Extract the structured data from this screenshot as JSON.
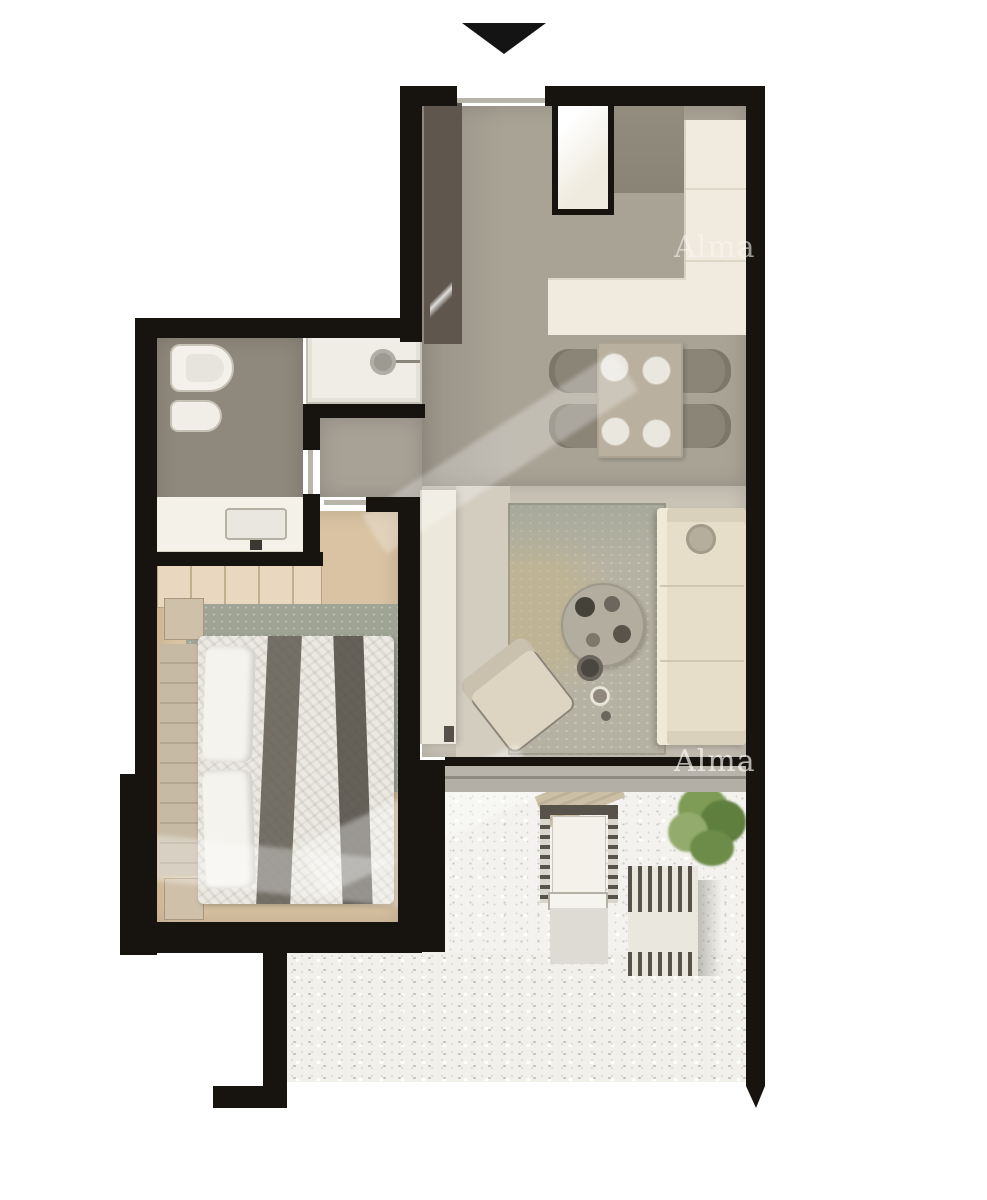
{
  "document": {
    "kind": "apartment floor plan, top-down render",
    "background": "#ffffff"
  },
  "watermark": {
    "text": "Alma",
    "occurrences": 2,
    "color": "rgba(249,247,241,0.58)"
  },
  "entrance": {
    "arrow": "black triangle pointing down into unit at top"
  },
  "palette": {
    "wall": "#17140f",
    "kitchen_floor": "#a9a396",
    "living_floor": "#cbc5b8",
    "hall_floor": "#a7a196",
    "bathroom_floor": "#8f887c",
    "bedroom_floor": "#d9c3a3",
    "balcony_floor": "#f3f2ee",
    "counter": "#f1ebdf",
    "sofa": "#e6dec9",
    "living_rug": "#b6b2a3",
    "bedroom_rug": "#9fa494",
    "wardrobe": "#e9d8bf",
    "plant": "#6d8c49",
    "door_leaf": "#b9b5aa",
    "sliding_door_band": "#b3afa6"
  },
  "rooms": {
    "kitchen_dining": [
      "fridge",
      "tall-cabinet",
      "l-shaped-counter",
      "dining-table",
      "4-chairs",
      "4-plates",
      "entry-closet"
    ],
    "living": [
      "area-rug",
      "sofa",
      "side-table",
      "round-coffee-table",
      "stools",
      "armchair",
      "tv-console"
    ],
    "bathroom": [
      "toilet",
      "bidet",
      "shower",
      "vanity-sink"
    ],
    "bedroom": [
      "wardrobe",
      "double-bed",
      "2-pillows",
      "2-throw-runners",
      "2-nightstands",
      "rug"
    ],
    "balcony": [
      "lounge-chair-with-cushion",
      "tray-table",
      "second-lounge-chair",
      "potted-plant"
    ]
  }
}
